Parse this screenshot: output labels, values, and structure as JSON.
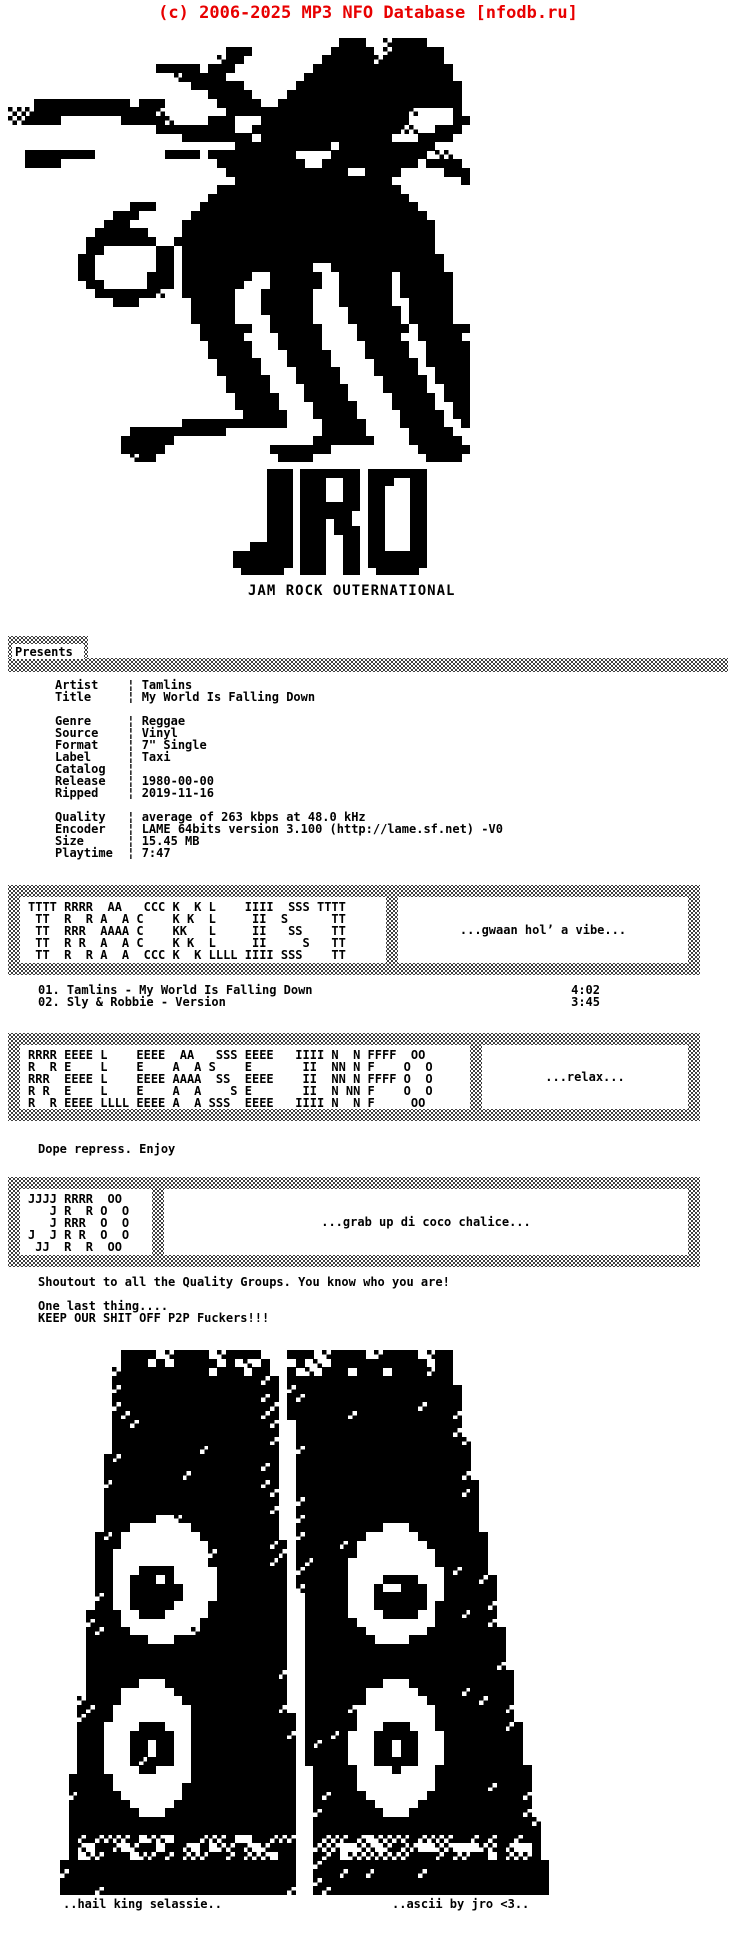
{
  "header": {
    "copyright": "(c) 2006-2025 MP3 NFO Database [nfodb.ru]"
  },
  "branding": {
    "logo_text": "JRO",
    "tagline": "JAM ROCK OUTERNATIONAL"
  },
  "presents_label": "Presents",
  "release_info": {
    "separator": "¦",
    "groups": [
      [
        {
          "label": "Artist",
          "value": "Tamlins"
        },
        {
          "label": "Title",
          "value": "My World Is Falling Down"
        }
      ],
      [
        {
          "label": "Genre",
          "value": "Reggae"
        },
        {
          "label": "Source",
          "value": "Vinyl"
        },
        {
          "label": "Format",
          "value": "7\" Single"
        },
        {
          "label": "Label",
          "value": "Taxi"
        },
        {
          "label": "Catalog",
          "value": ""
        },
        {
          "label": "Release",
          "value": "1980-00-00"
        },
        {
          "label": "Ripped",
          "value": "2019-11-16"
        }
      ],
      [
        {
          "label": "Quality",
          "value": "average of 263 kbps at 48.0 kHz"
        },
        {
          "label": "Encoder",
          "value": "LAME 64bits version 3.100 (http://lame.sf.net) -V0"
        },
        {
          "label": "Size",
          "value": "15.45 MB"
        },
        {
          "label": "Playtime",
          "value": "7:47"
        }
      ]
    ]
  },
  "tracklist": {
    "tracks": [
      {
        "no": "01.",
        "title": "Tamlins - My World Is Falling Down",
        "time": "4:02"
      },
      {
        "no": "02.",
        "title": "Sly & Robbie - Version",
        "time": "3:45"
      }
    ]
  },
  "ascii_boxes": {
    "tracklist_art": [
      "TTTT RRRR  AA   CCC K  K L    IIII  SSS TTTT",
      " TT  R  R A  A C    K K  L     II  S      TT",
      " TT  RRR  AAAA C    KK   L     II   SS    TT",
      " TT  R R  A  A C    K K  L     II     S   TT",
      " TT  R  R A  A  CCC K  K LLLL IIII SSS    TT"
    ],
    "tracklist_slogan": "...gwaan hol’ a vibe...",
    "release_art": [
      "RRRR EEEE L    EEEE  AA   SSS EEEE   IIII N  N FFFF  OO ",
      "R  R E    L    E    A  A S    E       II  NN N F    O  O",
      "RRR  EEEE L    EEEE AAAA  SS  EEEE    II  NN N FFFF O  O",
      "R R  E    L    E    A  A    S E       II  N NN F    O  O",
      "R  R EEEE LLLL EEEE A  A SSS  EEEE   IIII N  N F     OO "
    ],
    "release_slogan": "...relax...",
    "jro_art": [
      "JJJJ RRRR  OO ",
      "   J R  R O  O",
      "   J RRR  O  O",
      "J  J R R  O  O",
      " JJ  R  R  OO "
    ],
    "jro_slogan": "...grab up di coco chalice..."
  },
  "notes": {
    "repress": "Dope repress. Enjoy",
    "shoutout": "Shoutout to all the Quality Groups. You know who you are!",
    "one_last": "One last thing....",
    "keep": "KEEP OUR SHIT OFF P2P Fuckers!!!"
  },
  "footer": {
    "left": "..hail king selassie..",
    "right": "..ascii by jro <3.."
  },
  "colors": {
    "header_red": "#e80000",
    "ink": "#000000",
    "paper": "#ffffff",
    "dither_gray": "#888888"
  },
  "art": {
    "lion_cols": 53,
    "lion": [
      "                                      ###  +####     ",
      "                         ###         ##### +######   ",
      "                        +##         ######+#######   ",
      "                 ##### ###         ################  ",
      "                   +#####         #################  ",
      "                     ######      ################### ",
      "                       #####    #################### ",
      "   ########### ###      #####  ##################### ",
      "+++##############+       #####################+    # ",
      "++####       #####+    ###   #################     ##",
      "                 #########  #################++  ### ",
      "                    ######## ###############   ####  ",
      "                          ########### ###########    ",
      "  ########        #### ##########    ########### ++  ",
      "  ####                  ##########  ########### #### ",
      "                         ##############  ####     ###",
      "                          ##################        #",
      "                        #####################        ",
      "                       #######################       ",
      "              ###     #########################      ",
      "            ###      ###########################     ",
      "           ###      #############################    ",
      "          ######    #############################    ",
      "         ########  ##############################    ",
      "         ##      ## #############################    ",
      "        ##       ## ##############################   ",
      "        ##       ## ###############  #############   ",
      "        ##      ### ########  ######  ###### ######  ",
      "         ##     ### #######   ######  ###### ######  ",
      "          #######+  ######   ######   ###### ######  ",
      "            ###      #####   ######   ######  #####  ",
      "                     #####   ######    ###### #####  ",
      "                     #####    #####    ###### #####  ",
      "                      ######  ######    ###### ######",
      "                      #####    #####    #####  ##### ",
      "                       #####   #####     #####  #####",
      "                       #####    #####    #####  #####",
      "                        #####   #####     ##### #####",
      "                        #####    #####    #####  ####",
      "                         #####   #####     ##### ####",
      "                         #####    #####    #####  ###",
      "                          #####   #####     ##### ###",
      "                          #####    #####    #####  ##",
      "                           #####   #####     ##### ##",
      "                    ############    #####    #####  #",
      "              ###########           #####     #####  ",
      "             ######                #######    ###### ",
      "             #####            #######          ######",
      "              +##              ####             #### "
    ],
    "logo_cols": 23,
    "logo": [
      "    ### ####### #######",
      "    ### ###  ## ###  ##",
      "    ### ###  ## ##   ##",
      "    ### ###  ## ##   ##",
      "    ### ####### ##   ##",
      "    ### ######  ##   ##",
      "    ### ### ##  ##   ##",
      "    ### ### ### ##   ##",
      "    ### ###  ## ##   ##",
      "  ##### ###  ## ##   ##",
      "####### ###  ## #######",
      "####### ###  ## #######",
      " #####  ###  ##  ##### "
    ],
    "speakers": {
      "w": 620,
      "h": 545,
      "cols": 71,
      "rows": 63,
      "towers": [
        {
          "top": 4,
          "l0": 58,
          "l1": 2,
          "r0": 213,
          "r1": 240,
          "port": [
            488,
            510
          ],
          "holes": [
            {
              "cx": 102,
              "cy": 230,
              "rx": 53,
              "ry": 62,
              "blob": {
                "x": 95,
                "y": 242,
                "r": 26
              },
              "notch": {
                "x": 103,
                "y": 229
              }
            },
            {
              "cx": 90,
              "cy": 397,
              "rx": 45,
              "ry": 68,
              "ring": {
                "ro": 24,
                "ri": 6
              }
            }
          ]
        },
        {
          "top": 4,
          "l0": 228,
          "l1": 255,
          "r0": 392,
          "r1": 488,
          "port": [
            488,
            510
          ],
          "holes": [
            {
              "cx": 334,
              "cy": 235,
              "rx": 48,
              "ry": 60,
              "blob": {
                "x": 340,
                "y": 247,
                "r": 25
              },
              "notch": {
                "x": 332,
                "y": 236
              }
            },
            {
              "cx": 336,
              "cy": 397,
              "rx": 45,
              "ry": 68,
              "ring": {
                "ro": 24,
                "ri": 6
              }
            }
          ]
        }
      ]
    }
  }
}
